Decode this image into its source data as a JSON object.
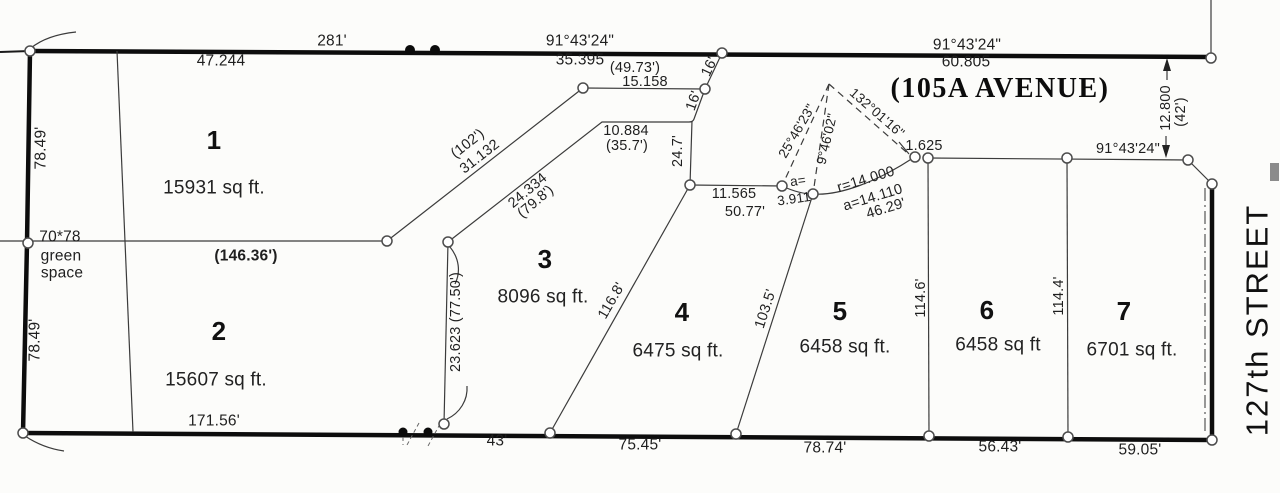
{
  "streets": {
    "avenue_label": "(105A  AVENUE)",
    "cross_street_label": "127th STREET"
  },
  "lots": [
    {
      "number": "1",
      "area": "15931 sq ft."
    },
    {
      "number": "2",
      "area": "15607 sq ft."
    },
    {
      "number": "3",
      "area": "8096 sq ft."
    },
    {
      "number": "4",
      "area": "6475 sq ft."
    },
    {
      "number": "5",
      "area": "6458 sq ft."
    },
    {
      "number": "6",
      "area": "6458 sq ft"
    },
    {
      "number": "7",
      "area": "6701 sq ft."
    }
  ],
  "green_space": {
    "dims": "70*78",
    "name_line1": "green",
    "name_line2": "space"
  },
  "top_boundary": {
    "seg1_m": "47.244",
    "seg1_ft": "281'",
    "seg2_bearing": "91°43'24\"",
    "seg2_m": "35.395",
    "seg3_bearing": "91°43'24\"",
    "seg3_m": "60.805"
  },
  "street_line": {
    "bearing": "91°43'24\"",
    "offset_m": "12.800",
    "offset_ft": "(42')"
  },
  "interior_dims": {
    "d_78_49_upper": "78.49'",
    "d_78_49_lower": "78.49'",
    "d_146_36": "(146.36')",
    "d_102": "(102')",
    "d_31_132": "31.132",
    "d_49_73": "(49.73')",
    "d_15_158": "15.158",
    "d_16_upper": "16'",
    "d_16_lower": "16'",
    "d_10_884": "10.884",
    "d_35_7": "(35.7')",
    "d_24_334": "24.334",
    "d_79_8": "(79.8')",
    "d_24_7": "24.7'",
    "d_23_623": "23.623 (77.50')",
    "d_116_8": "116.8'",
    "d_11_565": "11.565",
    "d_50_77": "50.77'",
    "d_103_5": "103.5'",
    "d_114_6": "114.6'",
    "d_114_4": "114.4'"
  },
  "curve": {
    "bearing_left": "25°46'23\"",
    "bearing_mid": "9°46'02\"",
    "delta": "132°01'16\"",
    "offset": "1.625",
    "a_prefix": "a=",
    "a_small": "3.911",
    "radius": "r=14.000",
    "arc_m": "a=14.110",
    "arc_ft": "46.29'"
  },
  "south_boundary": {
    "d_171_56": "171.56'",
    "d_43": "43'",
    "d_75_45": "75.45'",
    "d_78_74": "78.74'",
    "d_56_43": "56.43'",
    "d_59_05": "59.05'"
  }
}
